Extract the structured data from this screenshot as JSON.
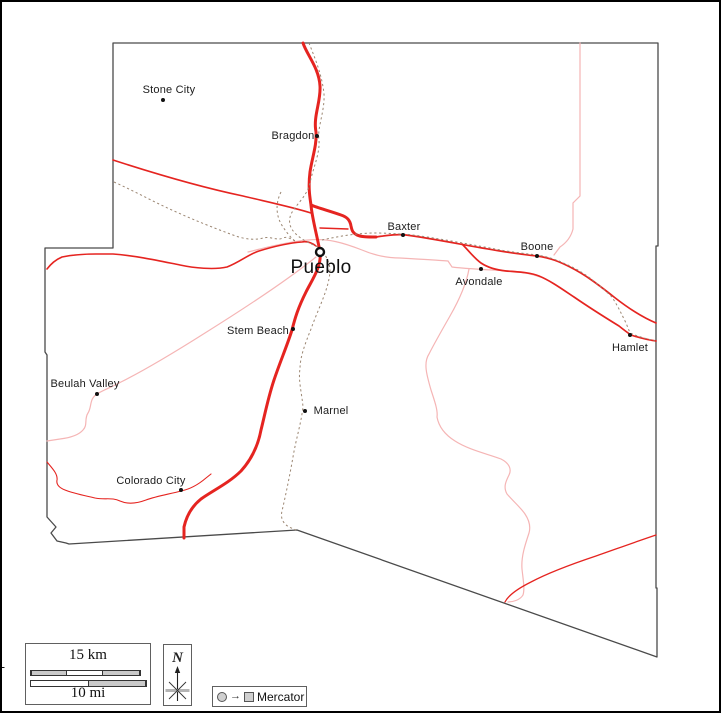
{
  "copyright": "© d-maps.com",
  "scalebar": {
    "km_label": "15 km",
    "mi_label": "10 mi"
  },
  "compass": {
    "north_label": "N"
  },
  "projection": {
    "label": "Mercator",
    "symbols": [
      "circle-icon",
      "arrow-right-icon",
      "square-icon"
    ]
  },
  "map": {
    "region": "county road map",
    "cities": [
      {
        "name": "Stone City"
      },
      {
        "name": "Bragdon"
      },
      {
        "name": "Baxter"
      },
      {
        "name": "Boone"
      },
      {
        "name": "Avondale"
      },
      {
        "name": "Hamlet"
      },
      {
        "name": "Pueblo"
      },
      {
        "name": "Stem Beach"
      },
      {
        "name": "Beulah Valley"
      },
      {
        "name": "Marnel"
      },
      {
        "name": "Colorado City"
      }
    ]
  },
  "colors": {
    "road_red": "#e52420",
    "river_pink": "#f5b5b5",
    "railroad_brown": "#9b8672",
    "boundary_gray": "#4a4a4a",
    "scalebar_fill": "#c9c9c9",
    "symbol_fill": "#cfcfcf",
    "frame_black": "#000000"
  }
}
